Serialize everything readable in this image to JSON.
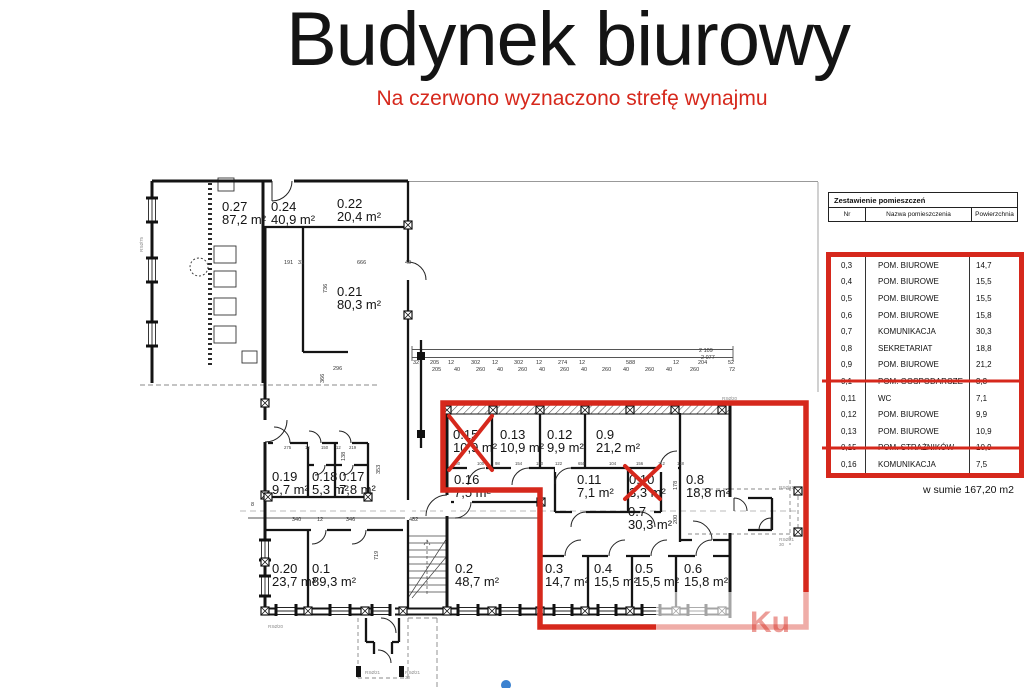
{
  "page": {
    "title": "Budynek biurowy",
    "subtitle": "Na czerwono wyznaczono strefę wynajmu"
  },
  "colors": {
    "zone_red": "#d6281c",
    "wall": "#141414"
  },
  "legend_table": {
    "title": "Zestawienie pomieszczeń",
    "columns": [
      "Nr",
      "Nazwa pomieszczenia",
      "Powierzchnia"
    ],
    "rows": [
      {
        "nr": "0,3",
        "name": "POM. BIUROWE",
        "area": "14,7",
        "struck": false
      },
      {
        "nr": "0,4",
        "name": "POM. BIUROWE",
        "area": "15,5",
        "struck": false
      },
      {
        "nr": "0,5",
        "name": "POM. BIUROWE",
        "area": "15,5",
        "struck": false
      },
      {
        "nr": "0,6",
        "name": "POM. BIUROWE",
        "area": "15,8",
        "struck": false
      },
      {
        "nr": "0,7",
        "name": "KOMUNIKACJA",
        "area": "30,3",
        "struck": false
      },
      {
        "nr": "0,8",
        "name": "SEKRETARIAT",
        "area": "18,8",
        "struck": false
      },
      {
        "nr": "0,9",
        "name": "POM. BIUROWE",
        "area": "21,2",
        "struck": false
      },
      {
        "nr": "0,1",
        "name": "POM. GOSPODARCZE",
        "area": "3,3",
        "struck": true
      },
      {
        "nr": "0,11",
        "name": "WC",
        "area": "7,1",
        "struck": false
      },
      {
        "nr": "0,12",
        "name": "POM. BIUROWE",
        "area": "9,9",
        "struck": false
      },
      {
        "nr": "0,13",
        "name": "POM. BIUROWE",
        "area": "10,9",
        "struck": false
      },
      {
        "nr": "0,15",
        "name": "POM. STRAŻNIKÓW",
        "area": "10,9",
        "struck": true
      },
      {
        "nr": "0,16",
        "name": "KOMUNIKACJA",
        "area": "7,5",
        "struck": false
      }
    ],
    "total": "w sumie 167,20 m2"
  },
  "plan": {
    "rooms": [
      {
        "id": "0.27",
        "area": "87,2 m²",
        "x": 222,
        "y": 211
      },
      {
        "id": "0.24",
        "area": "40,9 m²",
        "x": 271,
        "y": 211
      },
      {
        "id": "0.22",
        "area": "20,4 m²",
        "x": 337,
        "y": 208
      },
      {
        "id": "0.21",
        "area": "80,3 m²",
        "x": 337,
        "y": 296
      },
      {
        "id": "0.19",
        "area": "9,7 m²",
        "x": 272,
        "y": 481
      },
      {
        "id": "0.18",
        "area": "5,3 m²",
        "x": 312,
        "y": 481
      },
      {
        "id": "0.17",
        "area": "7,8 m²",
        "x": 339,
        "y": 481
      },
      {
        "id": "0.20",
        "area": "23,7 m²",
        "x": 272,
        "y": 573
      },
      {
        "id": "0.1",
        "area": "89,3 m²",
        "x": 312,
        "y": 573
      },
      {
        "id": "0.2",
        "area": "48,7 m²",
        "x": 455,
        "y": 573
      },
      {
        "id": "0.15",
        "area": "10,9 m²",
        "x": 453,
        "y": 439
      },
      {
        "id": "0.13",
        "area": "10,9 m²",
        "x": 500,
        "y": 439
      },
      {
        "id": "0.12",
        "area": "9,9 m²",
        "x": 547,
        "y": 439
      },
      {
        "id": "0.9",
        "area": "21,2 m²",
        "x": 596,
        "y": 439
      },
      {
        "id": "0.16",
        "area": "7,5 m²",
        "x": 454,
        "y": 484
      },
      {
        "id": "0.11",
        "area": "7,1 m²",
        "x": 577,
        "y": 484
      },
      {
        "id": "0.10",
        "area": "3,3 m²",
        "x": 629,
        "y": 484
      },
      {
        "id": "0.8",
        "area": "18,8 m²",
        "x": 686,
        "y": 484
      },
      {
        "id": "0.7",
        "area": "30,3 m²",
        "x": 628,
        "y": 516
      },
      {
        "id": "0.3",
        "area": "14,7 m²",
        "x": 545,
        "y": 573
      },
      {
        "id": "0.4",
        "area": "15,5 m²",
        "x": 594,
        "y": 573
      },
      {
        "id": "0.5",
        "area": "15,5 m²",
        "x": 635,
        "y": 573
      },
      {
        "id": "0.6",
        "area": "15,8 m²",
        "x": 684,
        "y": 573
      }
    ],
    "dims": [
      [
        "2 109",
        699,
        352
      ],
      [
        "2 077",
        701,
        359
      ],
      [
        "32",
        413,
        364
      ],
      [
        "205",
        430,
        364
      ],
      [
        "12",
        448,
        364
      ],
      [
        "302",
        471,
        364
      ],
      [
        "12",
        492,
        364
      ],
      [
        "302",
        514,
        364
      ],
      [
        "12",
        536,
        364
      ],
      [
        "274",
        558,
        364
      ],
      [
        "12",
        579,
        364
      ],
      [
        "588",
        626,
        364
      ],
      [
        "12",
        673,
        364
      ],
      [
        "204",
        698,
        364
      ],
      [
        "52",
        728,
        364
      ],
      [
        "205",
        432,
        371
      ],
      [
        "40",
        454,
        371
      ],
      [
        "260",
        476,
        371
      ],
      [
        "40",
        497,
        371
      ],
      [
        "260",
        518,
        371
      ],
      [
        "40",
        539,
        371
      ],
      [
        "260",
        560,
        371
      ],
      [
        "40",
        581,
        371
      ],
      [
        "260",
        602,
        371
      ],
      [
        "40",
        623,
        371
      ],
      [
        "260",
        645,
        371
      ],
      [
        "40",
        666,
        371
      ],
      [
        "260",
        690,
        371
      ],
      [
        "72",
        729,
        371
      ],
      [
        "191",
        284,
        264
      ],
      [
        "31",
        298,
        264
      ],
      [
        "666",
        357,
        264
      ],
      [
        "40",
        405,
        264
      ],
      [
        "736",
        327,
        293,
        -90
      ],
      [
        "296",
        333,
        370
      ],
      [
        "366",
        324,
        383,
        -90
      ],
      [
        "275",
        284,
        449
      ],
      [
        "12",
        305,
        449
      ],
      [
        "150",
        321,
        449
      ],
      [
        "12",
        336,
        449
      ],
      [
        "219",
        349,
        449
      ],
      [
        "353",
        380,
        474,
        -90
      ],
      [
        "138",
        345,
        461,
        -90
      ],
      [
        "8",
        251,
        506
      ],
      [
        "340",
        292,
        521
      ],
      [
        "12",
        317,
        521
      ],
      [
        "346",
        346,
        521
      ],
      [
        "482",
        409,
        521
      ],
      [
        "719",
        378,
        560,
        -90
      ],
      [
        "178",
        677,
        490,
        -90
      ],
      [
        "200",
        677,
        524,
        -90
      ],
      [
        "100",
        453,
        465
      ],
      [
        "100",
        477,
        465
      ],
      [
        "98",
        495,
        465
      ],
      [
        "154",
        515,
        465
      ],
      [
        "180",
        536,
        465
      ],
      [
        "122",
        555,
        465
      ],
      [
        "650",
        578,
        465
      ],
      [
        "104",
        609,
        465
      ],
      [
        "156",
        636,
        465
      ],
      [
        "112",
        658,
        465
      ],
      [
        "118",
        677,
        465
      ]
    ],
    "annotations": [
      [
        "RSØ20",
        722,
        400
      ],
      [
        "RSØ21",
        779,
        489
      ],
      [
        "RSØ21",
        779,
        541
      ],
      [
        "30",
        779,
        546
      ],
      [
        "RSØ21",
        365,
        674
      ],
      [
        "RSØ21",
        405,
        674
      ],
      [
        "30",
        405,
        679
      ],
      [
        "RSØ20",
        268,
        628
      ],
      [
        "RSØ75",
        143,
        252,
        -90
      ]
    ],
    "watermark": "Ku"
  }
}
